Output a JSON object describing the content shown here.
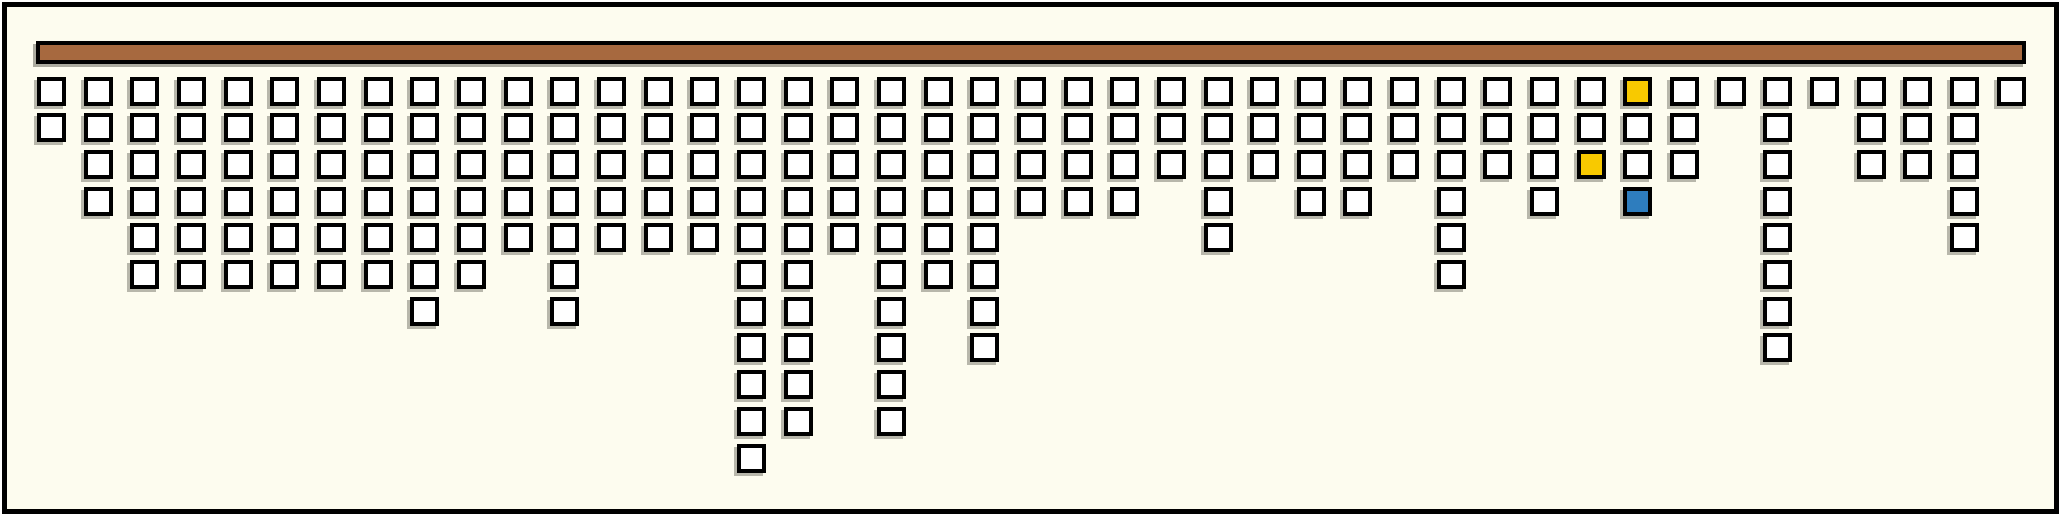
{
  "chart_data": {
    "type": "bar",
    "subtype": "hanging_unit_columns",
    "title": "",
    "xlabel": "",
    "ylabel": "",
    "categories": [
      1,
      2,
      3,
      4,
      5,
      6,
      7,
      8,
      9,
      10,
      11,
      12,
      13,
      14,
      15,
      16,
      17,
      18,
      19,
      20,
      21,
      22,
      23,
      24,
      25,
      26,
      27,
      28,
      29,
      30,
      31,
      32,
      33,
      34,
      35,
      36,
      37,
      38,
      39,
      40,
      41,
      42,
      43
    ],
    "values": [
      2,
      4,
      6,
      6,
      6,
      6,
      6,
      6,
      7,
      6,
      5,
      7,
      5,
      5,
      5,
      11,
      10,
      5,
      10,
      6,
      8,
      4,
      4,
      4,
      3,
      5,
      3,
      4,
      4,
      3,
      6,
      3,
      4,
      3,
      4,
      3,
      1,
      8,
      1,
      3,
      3,
      5,
      1
    ],
    "total_units": 211,
    "max_column_height": 11,
    "highlights": [
      {
        "col": 34,
        "row": 3,
        "color": "yellow"
      },
      {
        "col": 35,
        "row": 1,
        "color": "yellow"
      },
      {
        "col": 35,
        "row": 4,
        "color": "blue"
      }
    ],
    "colors": {
      "bar": "#A7693F",
      "square_fill": "#FFFFFF",
      "outline": "#000000",
      "background": "#FDFCEF",
      "yellow": "#F8C900",
      "blue": "#2E7DBE"
    },
    "layout": {
      "grid_on": false,
      "legend": "none",
      "columns": 43,
      "first_col_left": 37,
      "col_pitch": 46.66,
      "first_row_top": 76.5,
      "row_pitch": 36.7,
      "square_size": 29,
      "bar_left": 36,
      "bar_top": 41,
      "bar_width": 1990,
      "bar_height": 23
    }
  }
}
